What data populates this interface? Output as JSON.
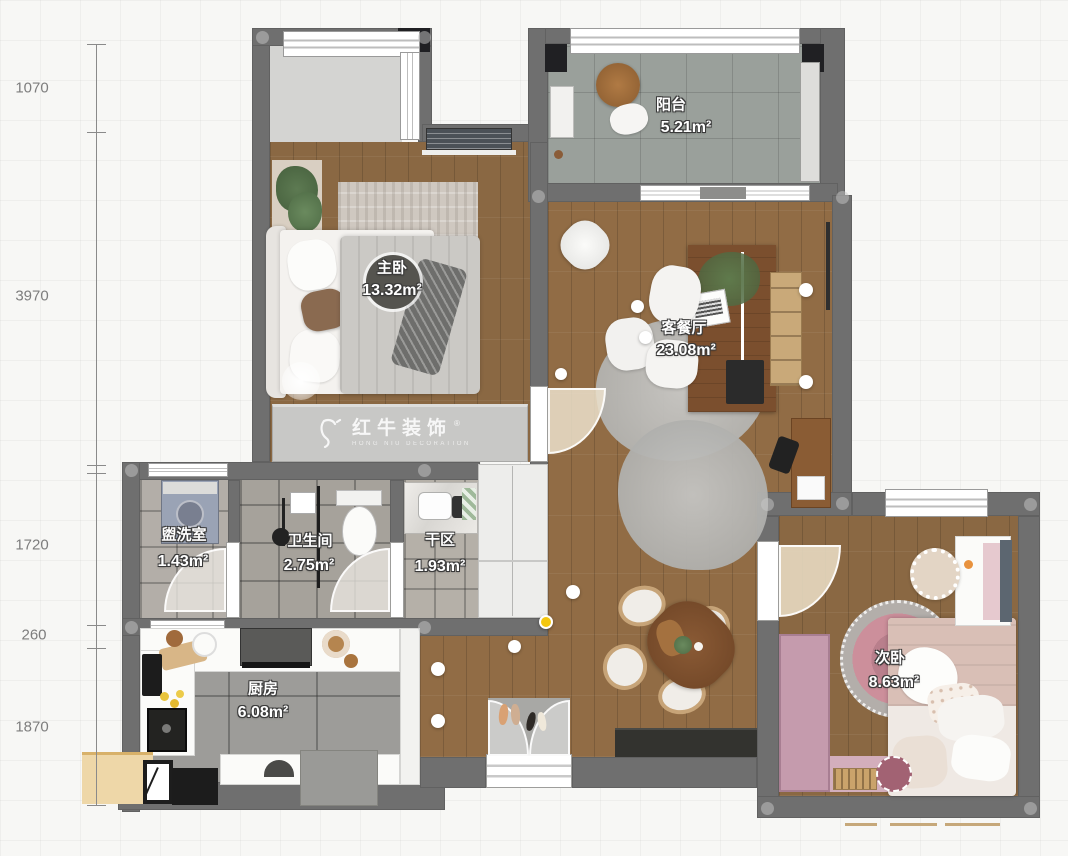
{
  "plan": {
    "title": "apartment-floorplan",
    "rooms": [
      {
        "id": "balcony",
        "name": "阳台",
        "area": "5.21m²"
      },
      {
        "id": "master-bedroom",
        "name": "主卧",
        "area": "13.32m²"
      },
      {
        "id": "living-dining",
        "name": "客餐厅",
        "area": "23.08m²"
      },
      {
        "id": "washroom",
        "name": "盥洗室",
        "area": "1.43m²"
      },
      {
        "id": "bathroom",
        "name": "卫生间",
        "area": "2.75m²"
      },
      {
        "id": "dry-area",
        "name": "干区",
        "area": "1.93m²"
      },
      {
        "id": "kitchen",
        "name": "厨房",
        "area": "6.08m²"
      },
      {
        "id": "second-bedroom",
        "name": "次卧",
        "area": "8.63m²"
      }
    ],
    "dimensions": [
      "1070",
      "3970",
      "1720",
      "260",
      "1870"
    ],
    "watermark": {
      "title": "红牛装饰",
      "subtitle": "HONG NIU DECORATION",
      "registered": "®"
    },
    "colors": {
      "wall": "#6f6f6f",
      "wood_floor": "#8a6843",
      "wardrobe_pink": "#c59bad",
      "marker_yellow": "#f4c70f"
    }
  }
}
